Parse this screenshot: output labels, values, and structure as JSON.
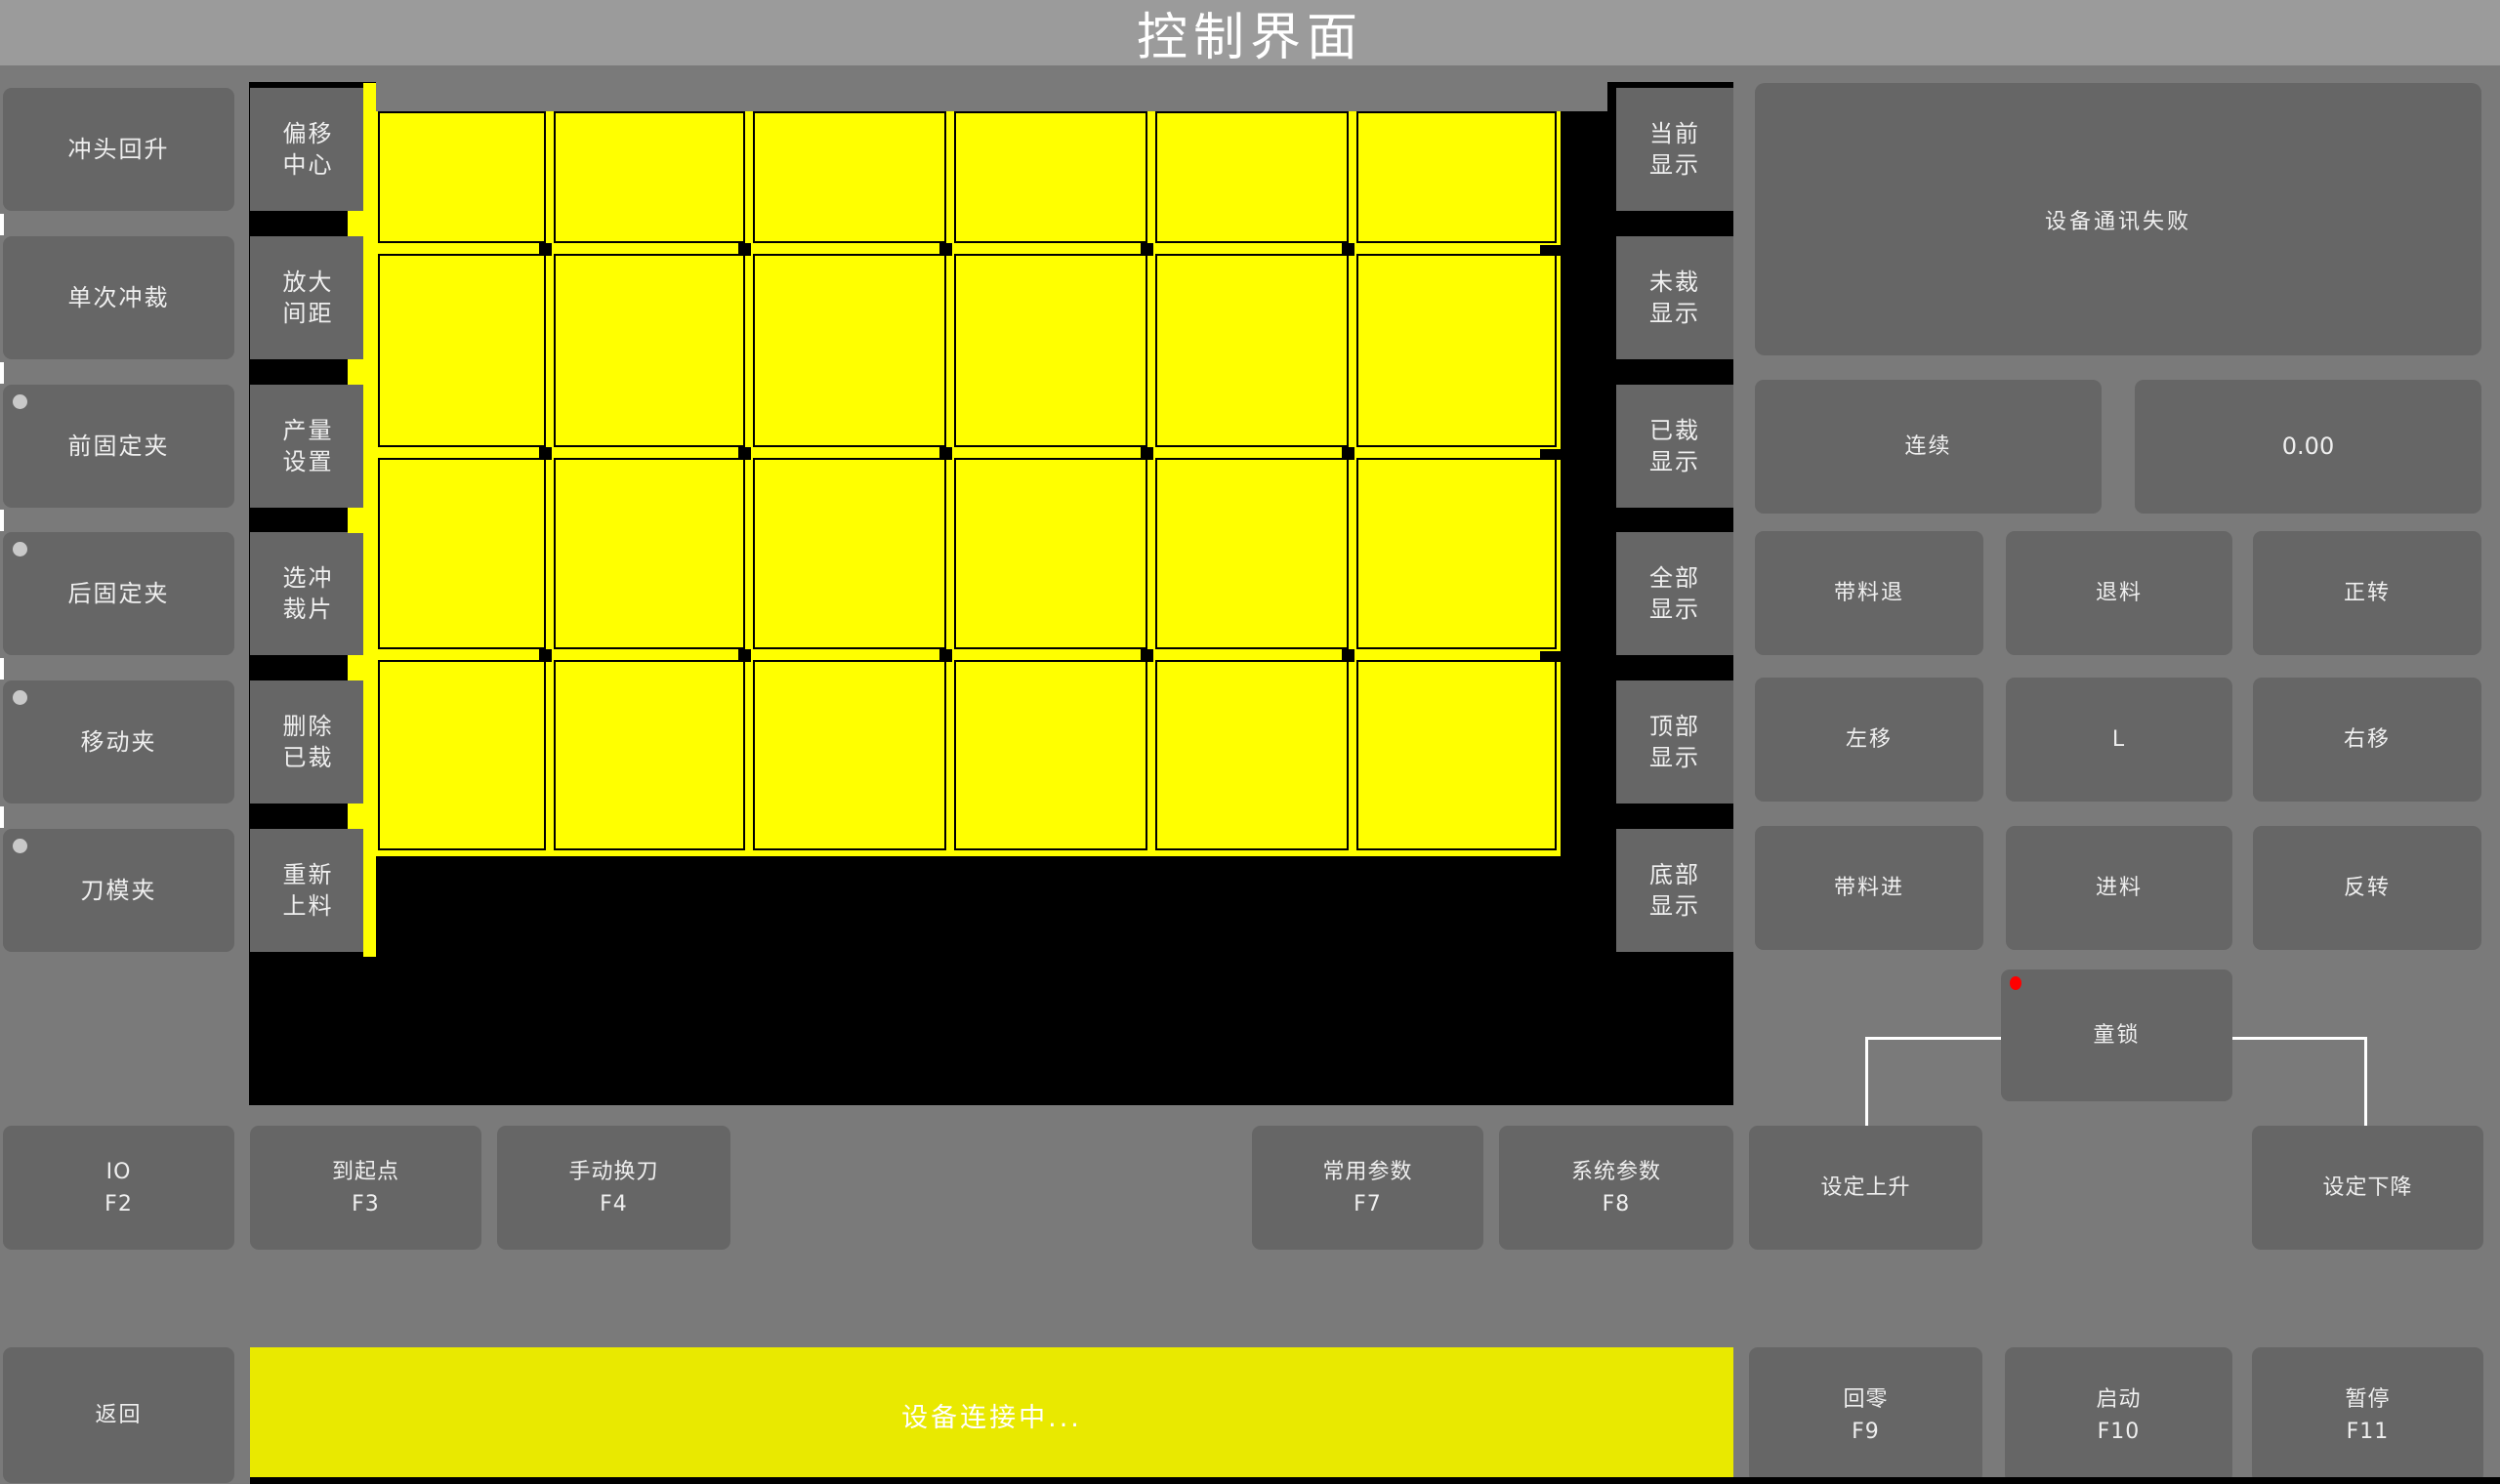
{
  "title": "控制界面",
  "left_panel": {
    "buttons": [
      {
        "label": "冲头回升",
        "indicator": false
      },
      {
        "label": "单次冲裁",
        "indicator": false
      },
      {
        "label": "前固定夹",
        "indicator": true
      },
      {
        "label": "后固定夹",
        "indicator": true
      },
      {
        "label": "移动夹",
        "indicator": true
      },
      {
        "label": "刀模夹",
        "indicator": true
      }
    ]
  },
  "tool_panel": {
    "buttons": [
      {
        "label": "偏移\n中心"
      },
      {
        "label": "放大\n间距"
      },
      {
        "label": "产量\n设置"
      },
      {
        "label": "选冲\n裁片"
      },
      {
        "label": "删除\n已裁"
      },
      {
        "label": "重新\n上料"
      }
    ]
  },
  "display_panel": {
    "buttons": [
      {
        "label": "当前\n显示"
      },
      {
        "label": "未裁\n显示"
      },
      {
        "label": "已裁\n显示"
      },
      {
        "label": "全部\n显示"
      },
      {
        "label": "顶部\n显示"
      },
      {
        "label": "底部\n显示"
      }
    ]
  },
  "canvas": {
    "rows": 4,
    "cols": 6,
    "sheet_color": "#ffff00",
    "grid_line_color": "#000000",
    "background_color": "#000000"
  },
  "right_panel": {
    "message": "设备通讯失败",
    "mode_button": "连续",
    "value_display": "0.00",
    "grid": [
      {
        "label": "带料退"
      },
      {
        "label": "退料"
      },
      {
        "label": "正转"
      },
      {
        "label": "左移"
      },
      {
        "label": "L"
      },
      {
        "label": "右移"
      },
      {
        "label": "带料进"
      },
      {
        "label": "进料"
      },
      {
        "label": "反转"
      }
    ],
    "lock_button": "童锁"
  },
  "function_row": [
    {
      "label": "IO",
      "fkey": "F2"
    },
    {
      "label": "到起点",
      "fkey": "F3"
    },
    {
      "label": "手动换刀",
      "fkey": "F4"
    },
    {
      "label": "常用参数",
      "fkey": "F7"
    },
    {
      "label": "系统参数",
      "fkey": "F8"
    },
    {
      "label": "设定上升",
      "fkey": ""
    },
    {
      "label": "设定下降",
      "fkey": ""
    }
  ],
  "bottom_bar": {
    "back": "返回",
    "status": "设备连接中...",
    "buttons": [
      {
        "label": "回零",
        "fkey": "F9"
      },
      {
        "label": "启动",
        "fkey": "F10"
      },
      {
        "label": "暂停",
        "fkey": "F11"
      }
    ]
  },
  "colors": {
    "page_background": "#7a7a7a",
    "titlebar": "#9b9b9b",
    "button": "#666666",
    "sheet_yellow": "#ffff00",
    "status_yellow": "#e9e900",
    "canvas_black": "#000000",
    "indicator_gray": "#c9c9c9",
    "alarm_red": "#ff0000",
    "text_white": "#ffffff"
  }
}
